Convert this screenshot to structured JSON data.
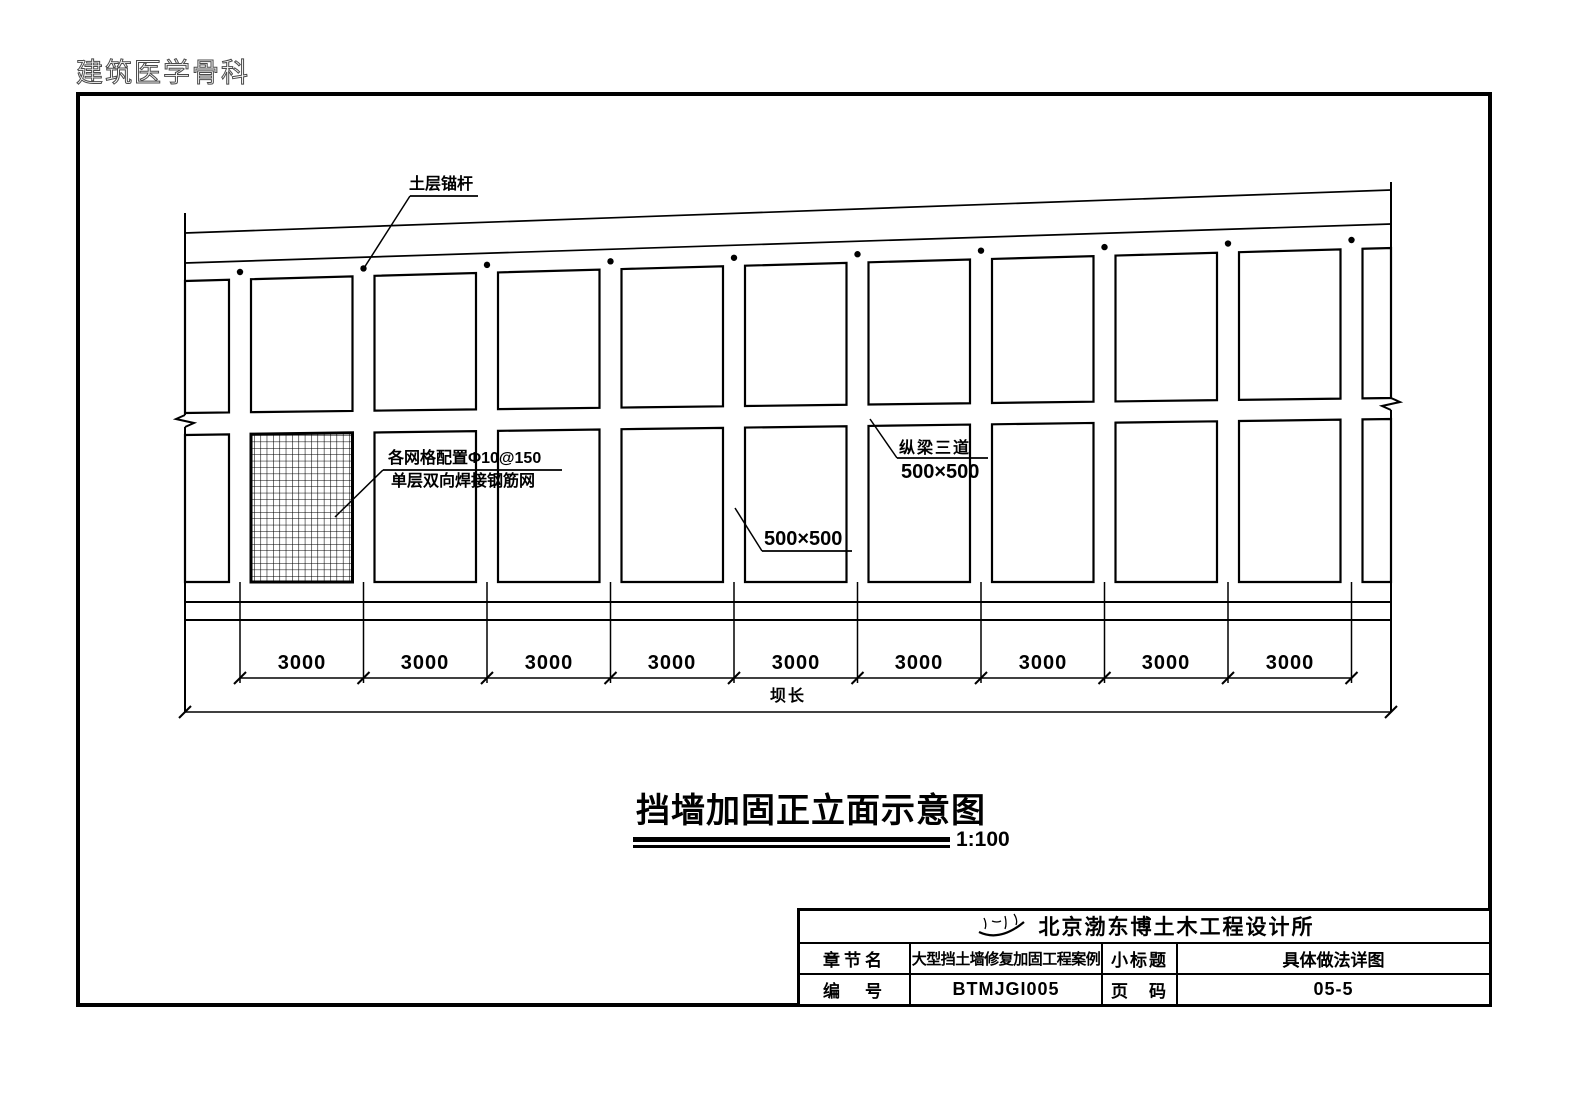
{
  "watermark": "建筑医学骨科",
  "drawing": {
    "anchor_label": "土层锚杆",
    "mesh_label_line1": "各网格配置Φ10@150",
    "mesh_label_line2": "单层双向焊接钢筋网",
    "beam_label_line1": "纵梁三道",
    "beam_label_line2": "500×500",
    "panel_size_label": "500×500",
    "bay_dims": [
      "3000",
      "3000",
      "3000",
      "3000",
      "3000",
      "3000",
      "3000",
      "3000",
      "3000"
    ],
    "total_dim_label": "坝长"
  },
  "title": {
    "text": "挡墙加固正立面示意图",
    "scale": "1:100"
  },
  "title_block": {
    "company": "北京渤东博土木工程设计所",
    "row2": {
      "label1": "章节名",
      "value1": "大型挡土墙修复加固工程案例",
      "label2": "小标题",
      "value2": "具体做法详图"
    },
    "row3": {
      "label1": "编　号",
      "value1": "BTMJGI005",
      "label2": "页　码",
      "value2": "05-5"
    }
  },
  "colors": {
    "line": "#000000",
    "background": "#ffffff"
  }
}
